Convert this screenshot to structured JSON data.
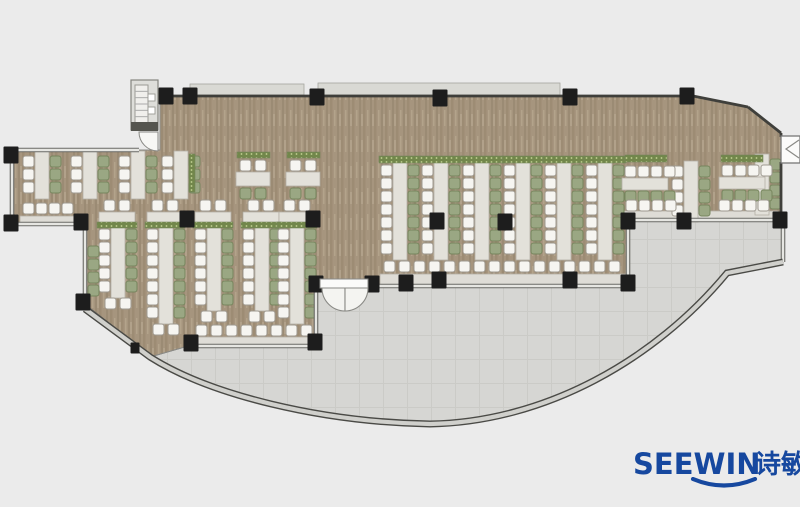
{
  "logo": {
    "brand": "SEEWIN",
    "cn": "诗敏",
    "color": "#16489f"
  },
  "floorplan": {
    "canvas": {
      "w": 800,
      "h": 507
    },
    "colors": {
      "bg": "#ebebeb",
      "floorBase": "#a6957e",
      "floorDark": "#9d8c74",
      "floorDark2": "#8f7f69",
      "floorLight": "#b3a38b",
      "floorLight2": "#bcad96",
      "terrace": "#d6d6d3",
      "terraceLine": "#cbcbc7",
      "wallDark": "#3f3f3b",
      "wallMid": "#6a6a66",
      "wallLight": "#e6e6e2",
      "curveDark": "#4a4a46",
      "curveLight": "#d0d0cc",
      "outline": "#8a8a86",
      "column": "#1d1d1d",
      "table": "#e3e1da",
      "tableStroke": "#b3afa5",
      "bench": "#dedcd6",
      "chairWhite": "#f6f5f1",
      "chairWhiteStroke": "#9e9990",
      "chairGreen": "#9aa783",
      "chairGreenStroke": "#76855d",
      "planter": "#72874b",
      "planterDot": "#c3d194",
      "band": "#d9d9d4",
      "bandStroke": "#a5a59e",
      "white": "#fbfbfa",
      "doorStroke": "#8a8a86"
    },
    "dining_path": "M160,96 L693,96 L748,107 L781,133 L781,220 L628,220 L628,286 L316,286 L316,346 L188,346 L150,357 L85,309 L85,224 L12,224 L12,150 L160,150 Z",
    "terrace_path": "M188,346 L316,346 L316,286 L628,286 L628,220 L783,220 L783,262 L727,273 C655,360 545,422 430,424 C320,422 210,395 150,357 Z",
    "curve_path": "M85,309 L150,357 C210,395 320,422 430,424 C545,422 655,360 727,273 L783,262",
    "top_bands": [
      [
        190,
        84,
        114,
        11
      ],
      [
        318,
        83,
        242,
        12
      ]
    ],
    "glass_walls": [
      [
        12,
        150,
        139,
        150
      ],
      [
        12,
        150,
        12,
        224
      ],
      [
        12,
        224,
        85,
        224
      ],
      [
        85,
        224,
        85,
        309
      ],
      [
        88,
        309,
        150,
        357
      ],
      [
        188,
        346,
        316,
        346
      ],
      [
        316,
        286,
        316,
        346
      ],
      [
        316,
        286,
        322,
        286
      ],
      [
        370,
        286,
        628,
        286
      ],
      [
        628,
        220,
        628,
        286
      ],
      [
        628,
        220,
        783,
        220
      ],
      [
        783,
        220,
        783,
        262
      ],
      [
        783,
        262,
        727,
        273
      ]
    ],
    "solid_walls": [
      [
        145,
        96,
        693,
        96
      ],
      [
        693,
        96,
        748,
        107
      ],
      [
        748,
        107,
        781,
        133
      ],
      [
        781,
        133,
        781,
        137
      ],
      [
        781,
        162,
        781,
        220
      ]
    ],
    "columns": [
      [
        166,
        96
      ],
      [
        190,
        96
      ],
      [
        317,
        97
      ],
      [
        440,
        98
      ],
      [
        570,
        97
      ],
      [
        687,
        96
      ],
      [
        780,
        220
      ],
      [
        684,
        221
      ],
      [
        628,
        221
      ],
      [
        406,
        283
      ],
      [
        439,
        280
      ],
      [
        570,
        280
      ],
      [
        628,
        283
      ],
      [
        316,
        284
      ],
      [
        372,
        284
      ],
      [
        315,
        342
      ],
      [
        191,
        343
      ],
      [
        187,
        219
      ],
      [
        313,
        219
      ],
      [
        437,
        221
      ],
      [
        505,
        222
      ],
      [
        11,
        155
      ],
      [
        11,
        223
      ],
      [
        81,
        222
      ],
      [
        83,
        302
      ],
      [
        135,
        348,
        9,
        11
      ]
    ],
    "benches": [
      [
        20,
        216,
        54,
        9
      ],
      [
        380,
        274,
        248,
        11
      ],
      [
        620,
        211,
        158,
        9
      ],
      [
        192,
        337,
        118,
        10
      ]
    ],
    "bench_tables": [
      {
        "cx": 117
      },
      {
        "cx": 165
      },
      {
        "cx": 213
      },
      {
        "cx": 261
      },
      {
        "cx": 297
      }
    ],
    "planters": [
      [
        189,
        154,
        6,
        38
      ],
      [
        97,
        222,
        40,
        6
      ],
      [
        145,
        222,
        40,
        6
      ],
      [
        193,
        222,
        40,
        6
      ],
      [
        241,
        222,
        40,
        6
      ],
      [
        277,
        222,
        40,
        6
      ],
      [
        237,
        152,
        33,
        6
      ],
      [
        287,
        152,
        33,
        6
      ],
      [
        379,
        156,
        42,
        7
      ],
      [
        420,
        156,
        42,
        7
      ],
      [
        461,
        156,
        42,
        7
      ],
      [
        502,
        156,
        42,
        7
      ],
      [
        543,
        156,
        42,
        7
      ],
      [
        584,
        156,
        42,
        7
      ],
      [
        625,
        155,
        42,
        7
      ],
      [
        721,
        155,
        42,
        7
      ]
    ],
    "vtables": [
      {
        "cx": 42,
        "y0": 156,
        "n": 3
      },
      {
        "cx": 90,
        "y0": 156,
        "n": 3
      },
      {
        "cx": 138,
        "y0": 156,
        "n": 3
      },
      {
        "cx": 181,
        "y0": 156,
        "n": 3
      },
      {
        "cx": 118,
        "y0": 229,
        "n": 5,
        "end": 1
      },
      {
        "cx": 166,
        "y0": 229,
        "n": 7,
        "end": 1
      },
      {
        "cx": 214,
        "y0": 229,
        "n": 6,
        "end": 1
      },
      {
        "cx": 262,
        "y0": 229,
        "n": 6,
        "end": 1
      },
      {
        "cx": 297,
        "y0": 229,
        "n": 7
      },
      {
        "cx": 400,
        "y0": 165,
        "n": 7
      },
      {
        "cx": 441,
        "y0": 165,
        "n": 7
      },
      {
        "cx": 482,
        "y0": 165,
        "n": 7
      },
      {
        "cx": 523,
        "y0": 165,
        "n": 7
      },
      {
        "cx": 564,
        "y0": 165,
        "n": 7
      },
      {
        "cx": 605,
        "y0": 165,
        "n": 7
      },
      {
        "cx": 691,
        "y0": 166,
        "n": 4
      },
      {
        "cx": 762,
        "y0": 159,
        "n": 4,
        "noWhite": 1
      }
    ],
    "htables": [
      {
        "x": 622,
        "y": 178,
        "w": 46,
        "cy": 166,
        "gy": 191,
        "n": 4
      },
      {
        "x": 719,
        "y": 177,
        "w": 46,
        "cy": 165,
        "gy": 190,
        "n": 4
      }
    ],
    "four_seaters": [
      {
        "cx": 253,
        "y": 160
      },
      {
        "cx": 303,
        "y": 160
      }
    ],
    "chair_rows": [
      {
        "x": 23,
        "y": 203,
        "n": 4,
        "pitch": 13,
        "kind": "w"
      },
      {
        "x": 384,
        "y": 261,
        "n": 16,
        "pitch": 15,
        "kind": "w"
      },
      {
        "x": 626,
        "y": 200,
        "n": 4,
        "pitch": 13,
        "kind": "w"
      },
      {
        "x": 719,
        "y": 200,
        "n": 4,
        "pitch": 13,
        "kind": "w"
      },
      {
        "x": 196,
        "y": 325,
        "n": 8,
        "pitch": 15,
        "kind": "w"
      }
    ],
    "chair_cols": [
      {
        "x": 88,
        "y": 246,
        "n": 4,
        "kind": "g"
      }
    ],
    "stair": {
      "outer": [
        131,
        80,
        27,
        50
      ],
      "inner": [
        135,
        85,
        13,
        38
      ],
      "knobs": [
        [
          138,
          94,
          9,
          9
        ],
        [
          138,
          107,
          9,
          9
        ]
      ],
      "cap": [
        131,
        122,
        27,
        9
      ]
    },
    "doors": {
      "main": {
        "lintel": [
          320,
          279,
          48,
          9
        ],
        "hl": [
          322,
          288
        ],
        "hr": [
          368,
          288
        ],
        "r": 23
      },
      "tl": {
        "hx": 158,
        "hy": 132,
        "r": 19
      },
      "notch": {
        "rect": [
          781,
          136,
          19,
          27
        ],
        "chevron": "M799,140 L786,149 L799,158"
      }
    }
  }
}
